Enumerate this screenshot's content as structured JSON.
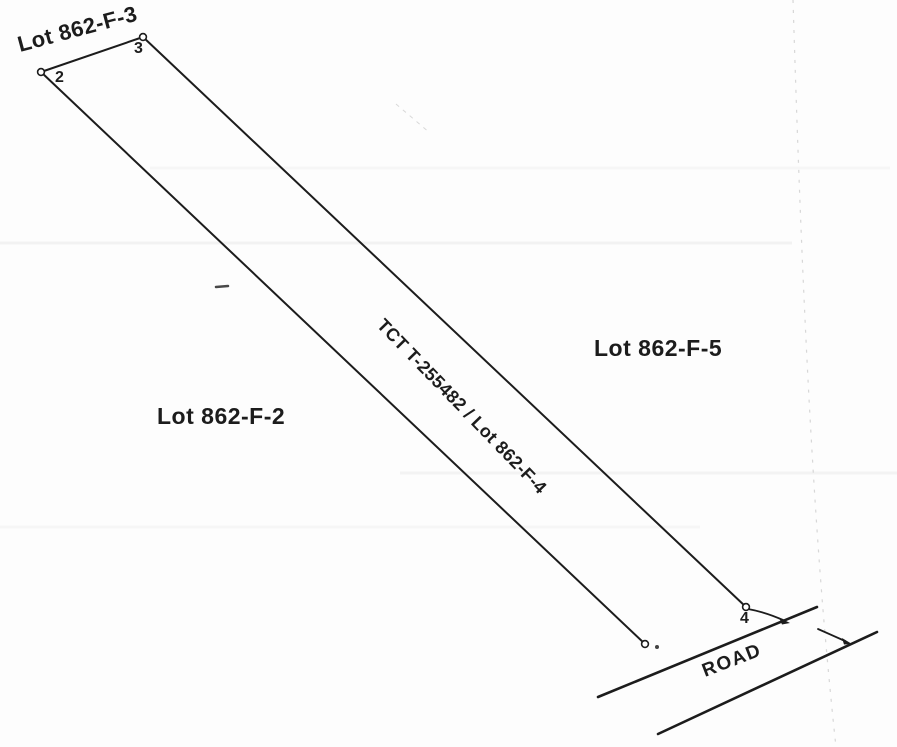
{
  "sketch": {
    "lots": {
      "adjacent_top": "Lot 862-F-3",
      "adjacent_left": "Lot 862-F-2",
      "adjacent_right": "Lot 862-F-5",
      "subject_strip": "TCT T-255482 / Lot 862-F-4"
    },
    "road_label": "ROAD",
    "corner_points": [
      "2",
      "3",
      "4"
    ],
    "colors": {
      "ink": "#1c1c1c",
      "paper": "#fdfdfd",
      "artifact": "#c9c9c9"
    }
  }
}
